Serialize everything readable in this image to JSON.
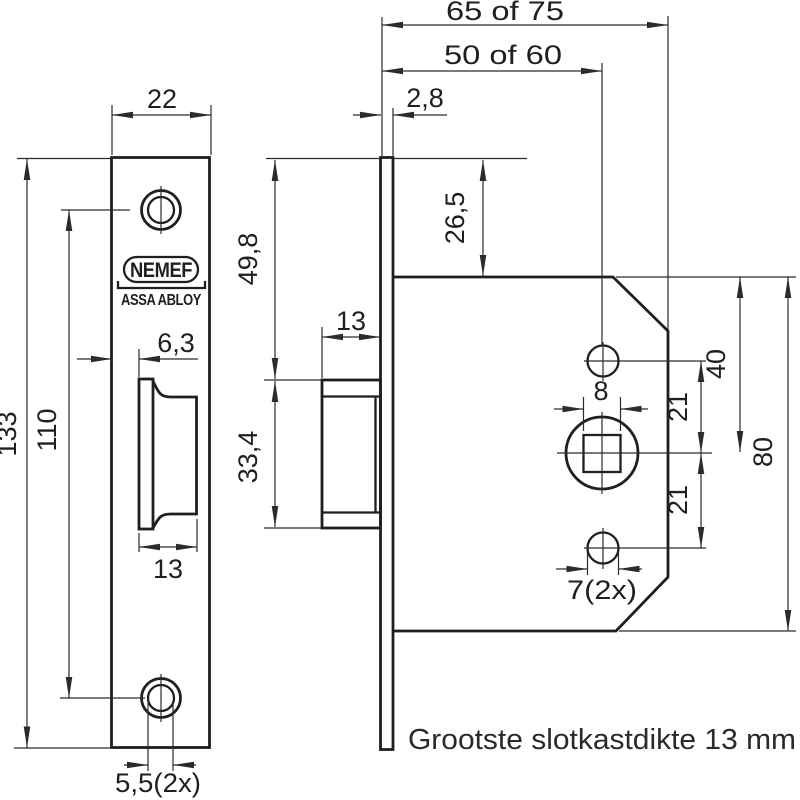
{
  "drawing": {
    "note": "Grootste slotkastdikte 13 mm",
    "brand": {
      "name": "NEMEF",
      "group": "ASSA ABLOY"
    },
    "dims": {
      "total_depth": "65 of 75",
      "backset": "50 of 60",
      "faceplate_thickness": "2,8",
      "faceplate_width": "22",
      "top_to_case": "26,5",
      "top_to_latch": "49,8",
      "latch_height": "33,4",
      "latch_protrusion": "13",
      "latch_inset": "6,3",
      "faceplate_height": "133",
      "screw_spacing": "110",
      "latch_width": "13",
      "screw_hole_dia": "5,5(2x)",
      "spindle_square": "8",
      "spindle_to_top_hole": "21",
      "spindle_to_bottom_hole": "21",
      "case_top_to_spindle": "40",
      "case_height": "80",
      "fix_hole_dia": "7(2x)"
    },
    "colors": {
      "line": "#1f1f1f",
      "background": "#ffffff"
    }
  }
}
